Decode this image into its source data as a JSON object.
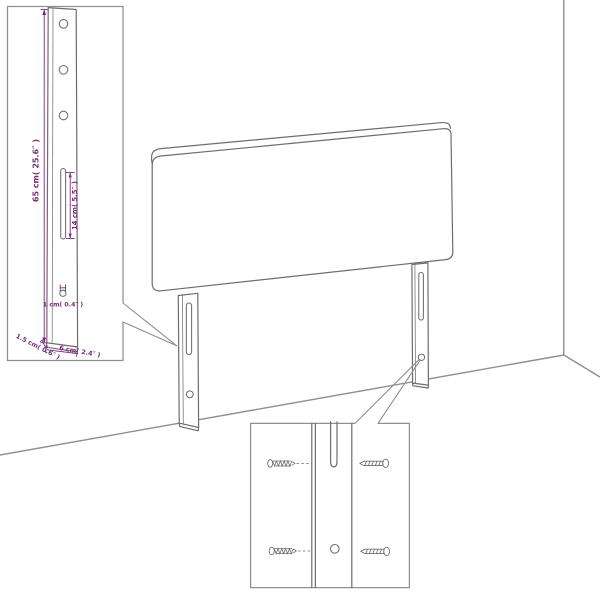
{
  "diagram": {
    "subject": "headboard-assembly-diagram",
    "colors": {
      "background": "#ffffff",
      "furniture_line": "#6e6e6e",
      "room_line": "#8f8f8f",
      "dimension": "#7a2c78"
    },
    "leg_detail_inset": {
      "height_label": "65 cm( 25.6″ )",
      "slot_label": "14 cm( 5.5″ )",
      "hole_label": "1 cm( 0.4″ )",
      "thickness_label": "1.5 cm( 0.6″ )",
      "width_label": "6 cm( 2.4″ )"
    }
  }
}
